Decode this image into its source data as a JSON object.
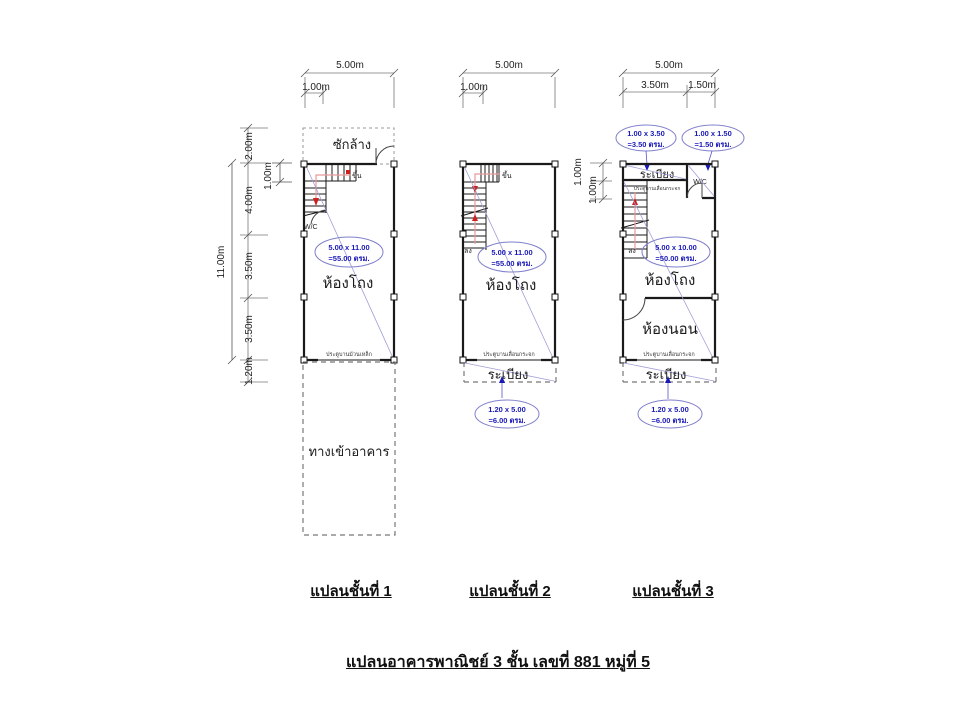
{
  "title": "แปลนอาคารพาณิชย์ 3 ชั้น เลขที่ 881 หมู่ที่ 5",
  "colors": {
    "wall": "#1a1a1a",
    "annotation_blue": "#1a1ab8",
    "ellipse_stroke": "#8080cc",
    "diagonal_blue": "#9f9fd8",
    "guide_pink": "#e89a9a",
    "arrow_red": "#cf1f1f",
    "dim_grey": "#555555"
  },
  "plans": {
    "p1": {
      "label": "แปลนชั้นที่ 1",
      "dim_top_total": "5.00m",
      "dim_top_sub": "1.00m",
      "dims_left": {
        "d200": "2.00m",
        "d100": "1.00m",
        "d400": "4.00m",
        "d350a": "3.50m",
        "d350b": "3.50m",
        "d120": "1.20m",
        "total": "11.00m"
      },
      "laundry": "ซักล้าง",
      "up": "ขึ้น",
      "wc": "W/C",
      "hall": "ห้องโถง",
      "entrance": "ทางเข้าอาคาร",
      "door_note": "ประตูบานม้วนเหล็ก",
      "area1": "5.00 x 11.00",
      "area2": "=55.00 ตรม."
    },
    "p2": {
      "label": "แปลนชั้นที่ 2",
      "dim_top_total": "5.00m",
      "dim_top_sub": "1.00m",
      "up": "ขึ้น",
      "down": "ลง",
      "hall": "ห้องโถง",
      "balcony": "ระเบียง",
      "door_note": "ประตูบานเลื่อนกระจก",
      "area1": "5.00 x 11.00",
      "area2": "=55.00 ตรม.",
      "bal_area1": "1.20 x 5.00",
      "bal_area2": "=6.00 ตรม."
    },
    "p3": {
      "label": "แปลนชั้นที่ 3",
      "dim_top_total": "5.00m",
      "dim_top_sub1": "3.50m",
      "dim_top_sub2": "1.50m",
      "dims_left": {
        "d100a": "1.00m",
        "d100b": "1.00m"
      },
      "balcony_top": "ระเบียง",
      "wc": "W/C",
      "down": "ลง",
      "hall": "ห้องโถง",
      "bedroom": "ห้องนอน",
      "balcony": "ระเบียง",
      "door_note_top": "ประตูบานเลื่อนกระจก",
      "door_note": "ประตูบานเลื่อนกระจก",
      "cal1a": "1.00 x 3.50",
      "cal1b": "=3.50 ตรม.",
      "cal2a": "1.00 x 1.50",
      "cal2b": "=1.50 ตรม.",
      "area1": "5.00 x 10.00",
      "area2": "=50.00 ตรม.",
      "bal_area1": "1.20 x 5.00",
      "bal_area2": "=6.00 ตรม."
    }
  }
}
